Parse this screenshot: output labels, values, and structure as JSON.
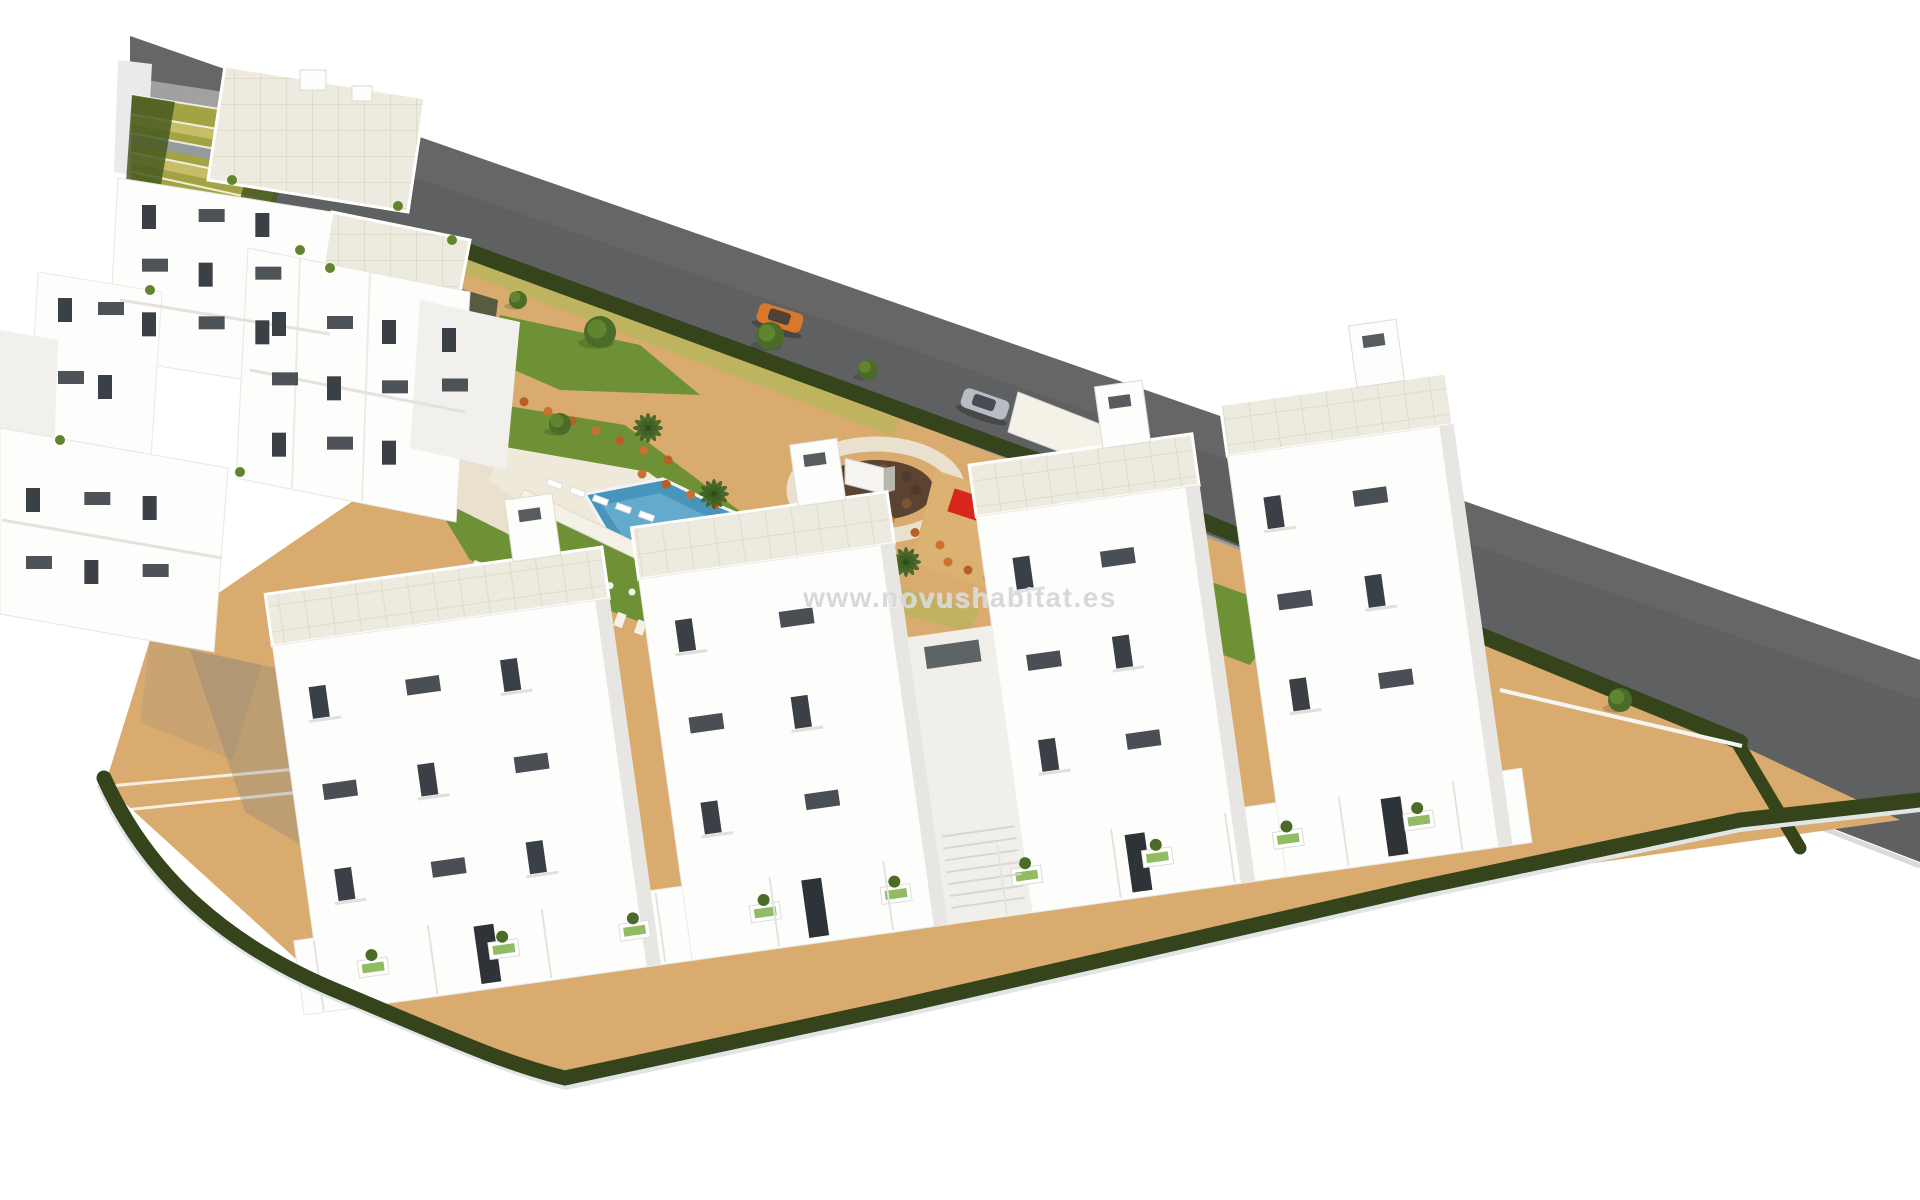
{
  "watermark": {
    "text": "www.novushabitat.es"
  },
  "colors": {
    "background": "#ffffff",
    "road": "#5f6061",
    "road_far": "#6b6c6d",
    "road_edge": "#d8dadb",
    "sidewalk": "#a7a8a6",
    "hedge": "#35441b",
    "hedge_light": "#47591f",
    "curb": "#e2e5e7",
    "sand": "#d9ab6e",
    "sand_shade": "#c99a5c",
    "play_sand": "#dcb273",
    "lawn": "#6f9135",
    "lawn_light": "#82a23e",
    "path": "#e9e0cd",
    "path_light": "#f4f1e6",
    "verge": "#b9b45c",
    "dark_bed": "#49523a",
    "pool": "#4795bd",
    "pool_light": "#71b4d3",
    "pool_rim": "#f2f4f4",
    "deck": "#efe9da",
    "building": "#fdfdfc",
    "building_mid": "#f1f0ec",
    "building_side": "#e7e6e2",
    "wall_light": "#e8eaec",
    "roof_tile": "#edeadf",
    "roof_line": "#dcd6c3",
    "window": "#3a4045",
    "window_light": "#9aa2a8",
    "door": "#2e3337",
    "recess": "#f1efe9",
    "monument": "#f5f4f1",
    "monument_side": "#b9b6ae",
    "round_center": "#5a4330",
    "round_shrub": "#7a5433",
    "round_shrub_dark": "#4e3a28",
    "shrub_orange": "#b85f27",
    "shrub_orange2": "#ca7031",
    "tree": "#4b6c29",
    "tree_light": "#61842f",
    "palm": "#3e6124",
    "play_red": "#d8271a",
    "play_green": "#7fb048",
    "play_yellow": "#c3cc52",
    "car_orange": "#d9772a",
    "car_silver": "#b7bdc3",
    "car_white": "#f3f4f5",
    "car_glass": "#33383d",
    "stair_olive": "#a3a343",
    "stair_yellow": "#c8bf6a",
    "step_gray": "#939ba1",
    "shadow": "#7e7e7e",
    "watermark": "#d5d7d8"
  }
}
